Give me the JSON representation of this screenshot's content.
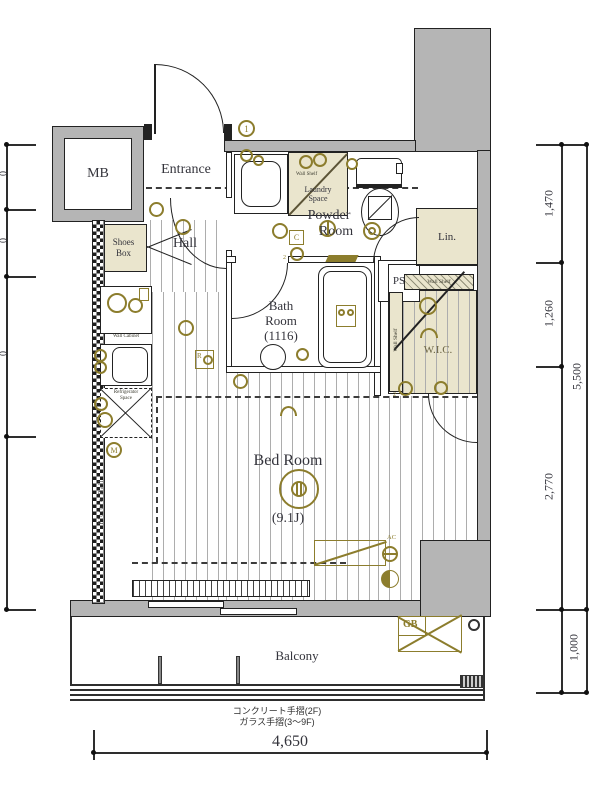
{
  "labels": {
    "mb": "MB",
    "entrance": "Entrance",
    "hall": "Hall",
    "shoes1": "Shoes",
    "shoes2": "Box",
    "powder1": "Powder",
    "powder2": "Room",
    "laundry1": "Laundry",
    "laundry2": "Space",
    "bath1": "Bath",
    "bath2": "Room",
    "bath3": "(1116)",
    "ps": "PS",
    "lin": "Lin.",
    "wic": "W.I.C.",
    "bed": "Bed Room",
    "bed_size": "(9.1J)",
    "balcony": "Balcony"
  },
  "fixtures": {
    "wall_shelf_laundry": "Wall Shelf",
    "wall_shelf_wic_top": "Wall Shelf",
    "wall_shelf_wic_side": "Wall Shelf",
    "wall_cabinet": "Wall Cabinet",
    "fridge1": "Refrigerator",
    "fridge2": "Space",
    "picture_rail": "Picture Rail",
    "gb": "GB",
    "ac": "AC"
  },
  "marks": {
    "door_number": "1",
    "c": "C",
    "r": "R",
    "m": "M",
    "two_a": "2",
    "two_b": "2"
  },
  "dims": {
    "right1": "1,470",
    "right2": "1,260",
    "right3": "2,770",
    "right_total": "5,500",
    "balcony_depth": "1,000",
    "bottom_width": "4,650",
    "left_frag1": "0",
    "left_frag2": "0",
    "left_frag3": "0"
  },
  "notes": {
    "handrail1": "コンクリート手摺(2F)",
    "handrail2": "ガラス手摺(3〜9F)"
  },
  "colors": {
    "wall_gray": "#b5b5b5",
    "fitting_beige": "#eae5cd",
    "symbol_olive": "#8c7d2d"
  }
}
